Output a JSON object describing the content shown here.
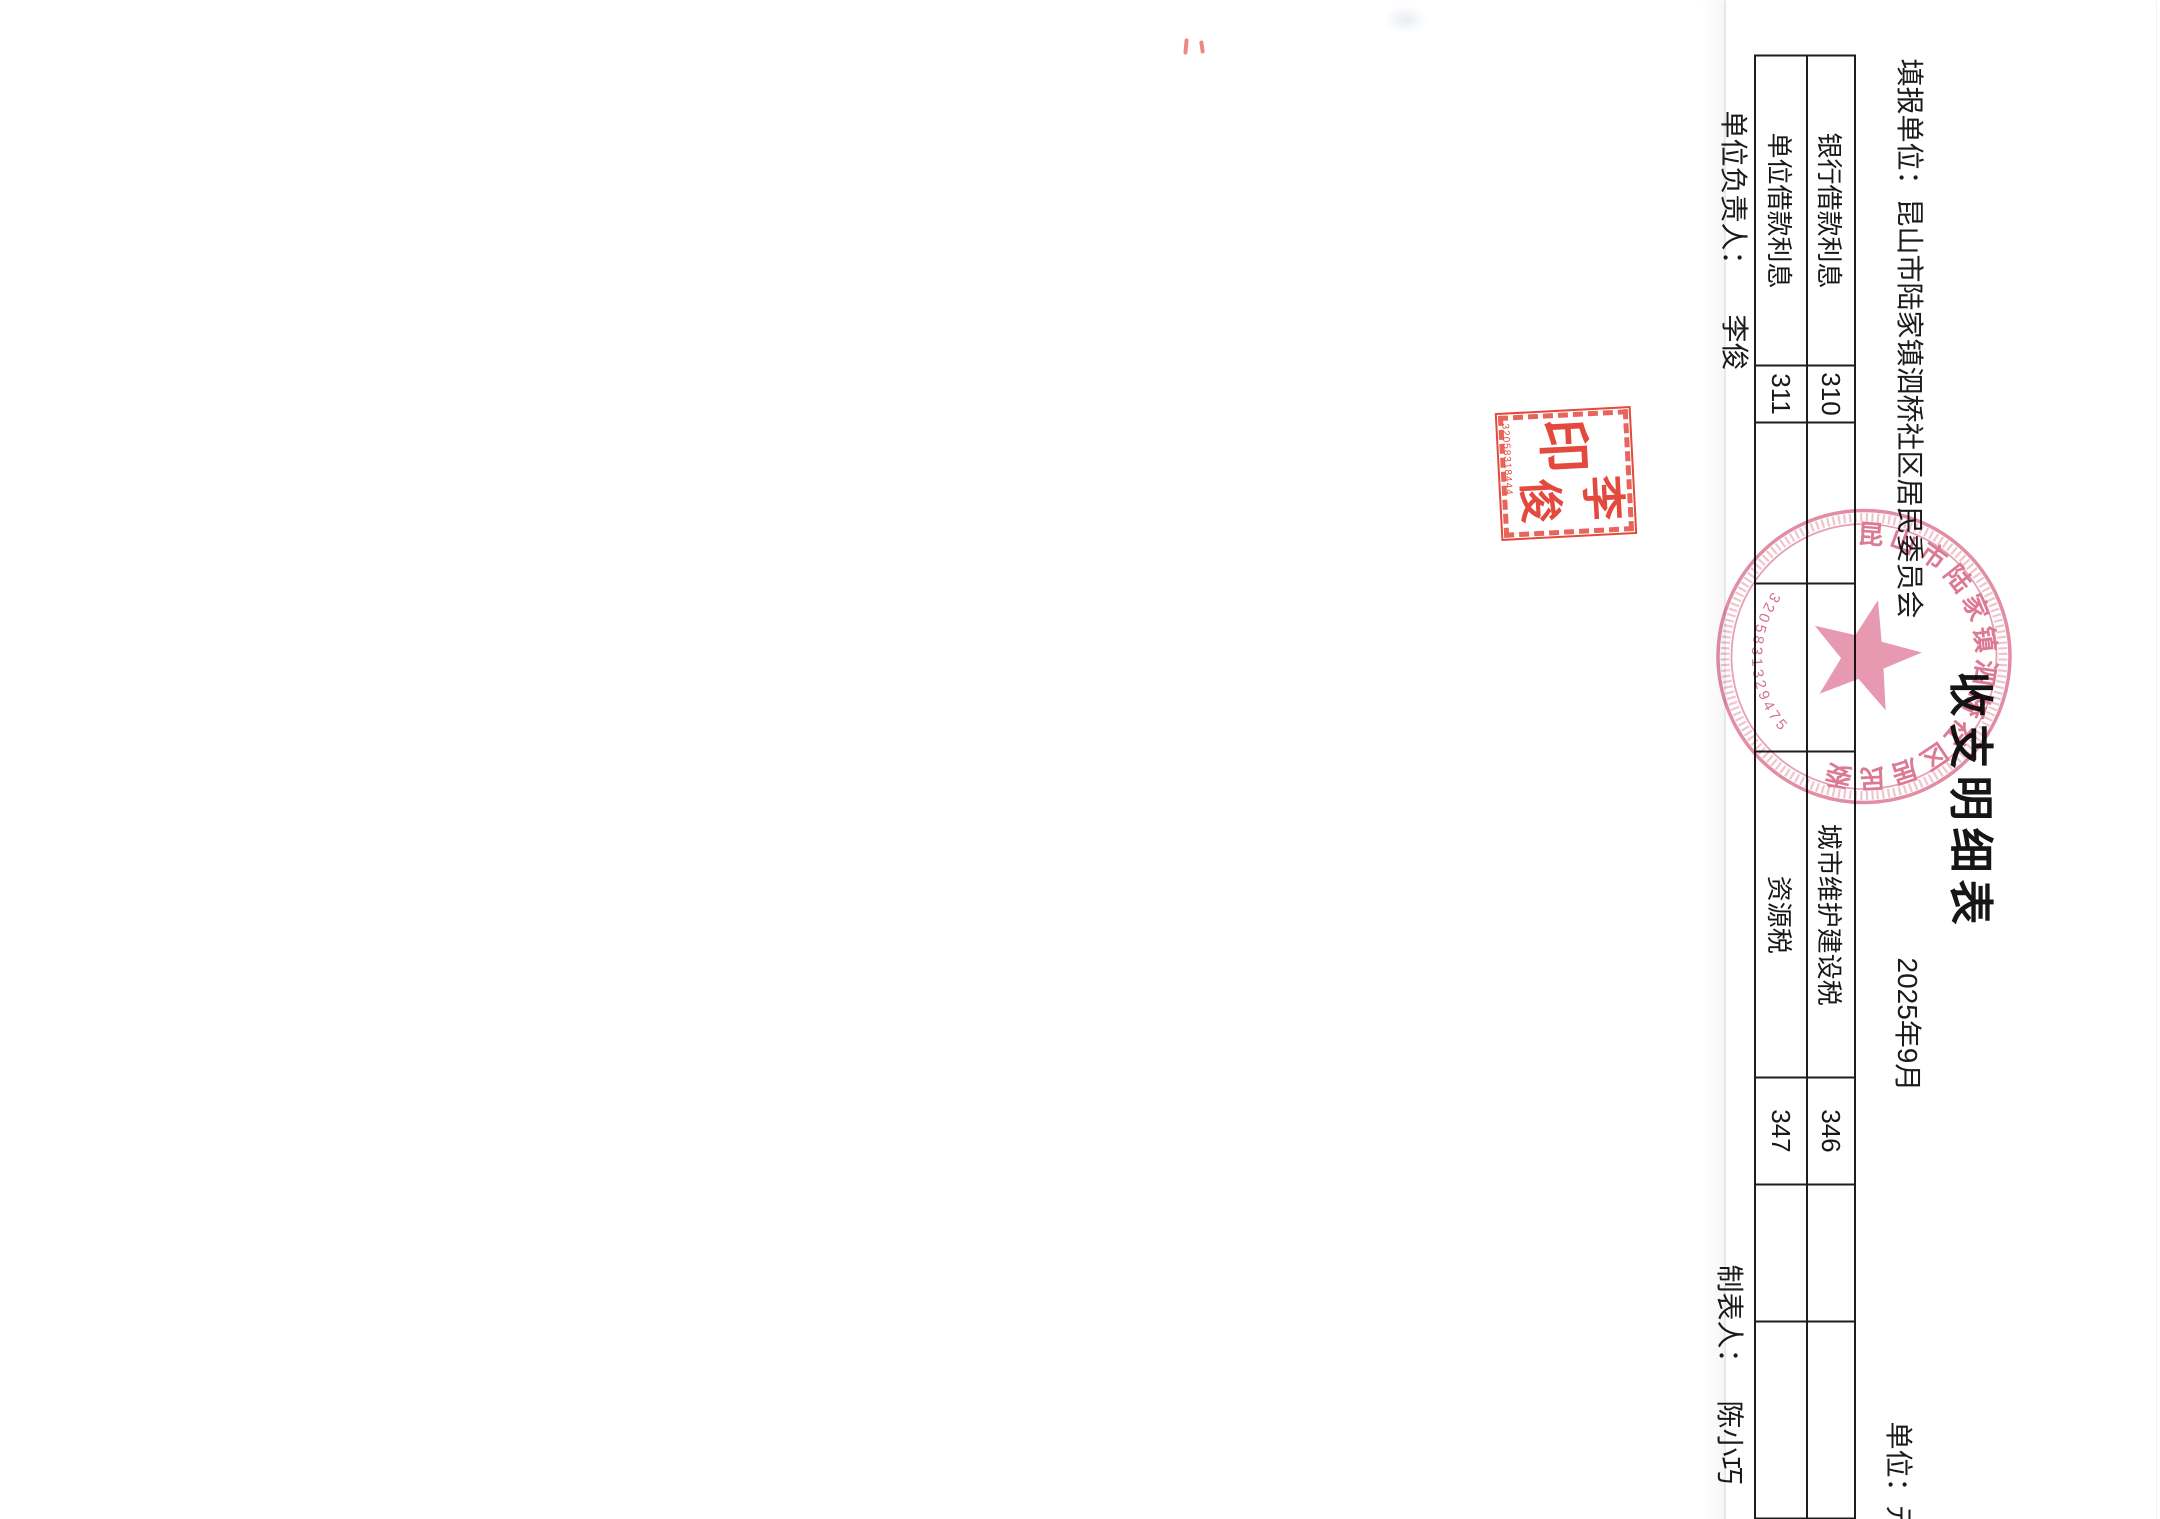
{
  "document": {
    "title": "收支明细表",
    "header": {
      "reporting_unit_label": "填报单位：",
      "reporting_unit_name": "昆山市陆家镇泗桥社区居民委员会",
      "period": "2025年9月",
      "unit_of_measure": "单位：元"
    },
    "table": {
      "rows": [
        {
          "cells": [
            "银行借款利息",
            "310",
            "",
            "",
            "城市维护建设税",
            "346",
            "",
            ""
          ]
        },
        {
          "cells": [
            "单位借款利息",
            "311",
            "",
            "",
            "资源税",
            "347",
            "",
            ""
          ]
        }
      ]
    },
    "footer": {
      "responsible_person_label": "单位负责人：",
      "responsible_person": "李俊",
      "preparer_label": "制表人：",
      "preparer": "陈小巧"
    },
    "seals": {
      "round_official_seal": {
        "organization": "昆山市陆家镇泗桥社区居民委员会",
        "registration_number": "3205831329475"
      },
      "name_seal": {
        "name_char_top": "李",
        "name_char_bottom": "俊",
        "seal_char": "印",
        "registration_number": "32058318444"
      }
    },
    "colors": {
      "ink": "#1c1c1c",
      "stamp_red": "#e23b2e",
      "seal_pink": "#d96e8c"
    }
  }
}
